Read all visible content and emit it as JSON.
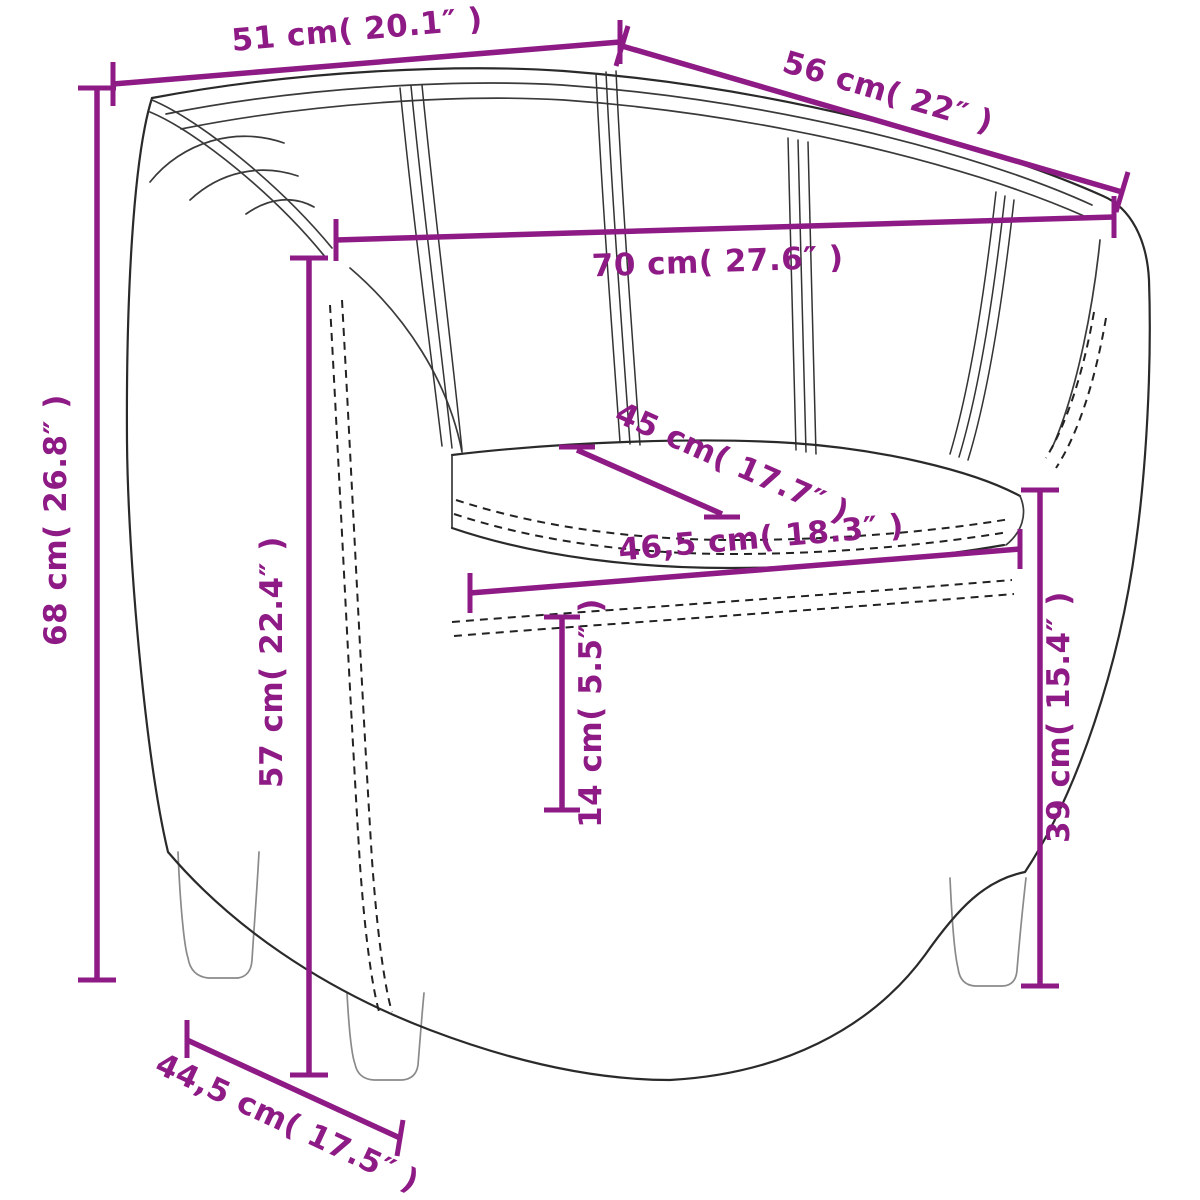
{
  "diagram": {
    "type": "product-dimension-diagram",
    "subject": "tub chair line drawing with measurements",
    "accent_color": "#8E1B85",
    "line_color": "#2A2A2A",
    "background_color": "#FFFFFF",
    "dimensions": {
      "top_width": {
        "label": "51 cm( 20.1″ )",
        "cm": "51",
        "inches": "20.1"
      },
      "top_depth": {
        "label": "56 cm( 22″ )",
        "cm": "56",
        "inches": "22"
      },
      "inner_width": {
        "label": "70 cm( 27.6″ )",
        "cm": "70",
        "inches": "27.6"
      },
      "overall_height": {
        "label": "68 cm( 26.8″ )",
        "cm": "68",
        "inches": "26.8"
      },
      "back_height": {
        "label": "57 cm( 22.4″ )",
        "cm": "57",
        "inches": "22.4"
      },
      "seat_depth": {
        "label": "45 cm( 17.7″ )",
        "cm": "45",
        "inches": "17.7"
      },
      "seat_width": {
        "label": "46,5 cm( 18.3″ )",
        "cm": "46,5",
        "inches": "18.3"
      },
      "cushion_height": {
        "label": "14 cm( 5.5″ )",
        "cm": "14",
        "inches": "5.5"
      },
      "seat_height": {
        "label": "39 cm( 15.4″ )",
        "cm": "39",
        "inches": "15.4"
      },
      "base_depth": {
        "label": "44,5 cm( 17.5″ )",
        "cm": "44,5",
        "inches": "17.5"
      }
    }
  }
}
